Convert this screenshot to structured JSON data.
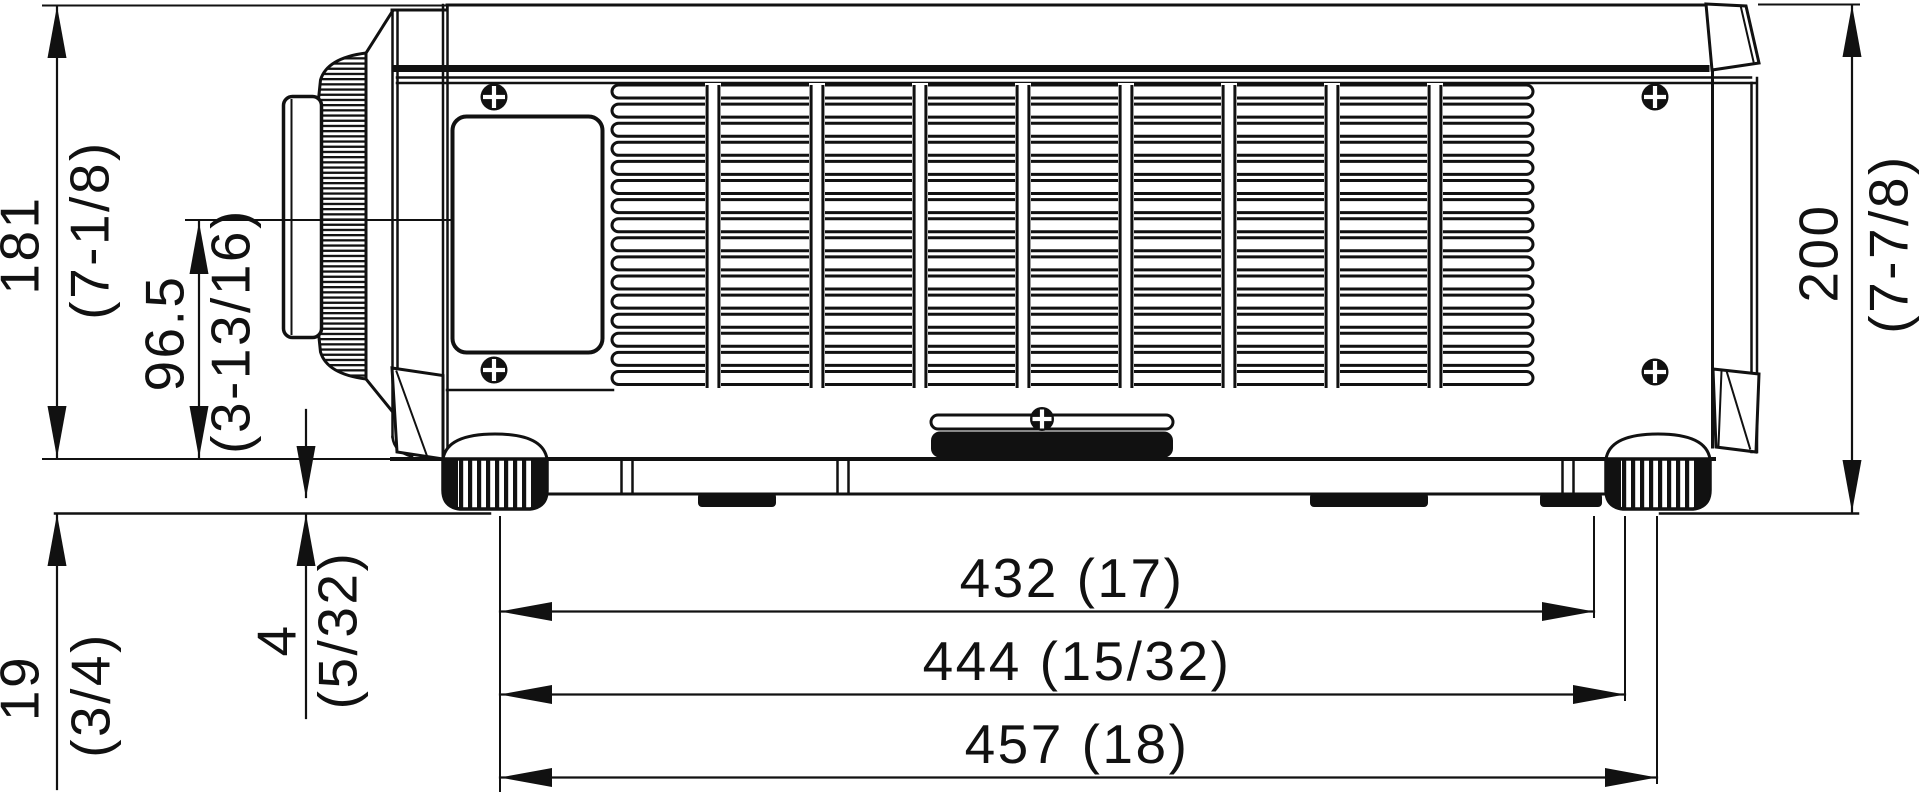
{
  "dimensions": {
    "body_height": {
      "value": "181",
      "inch": "(7-1/8)"
    },
    "lens_center_height": {
      "value": "96.5",
      "inch": "(3-13/16)"
    },
    "foot_height": {
      "value": "19",
      "inch": "(3/4)"
    },
    "foot_clearance": {
      "value": "4",
      "inch": "(5/32)"
    },
    "overall_height": {
      "value": "200",
      "inch": "(7-7/8)"
    },
    "foot_spacing": {
      "label": "432 (17)"
    },
    "body_depth": {
      "label": "444 (15/32)"
    },
    "overall_depth": {
      "label": "457 (18)"
    }
  },
  "colors": {
    "line": "#111111",
    "background": "#ffffff"
  }
}
